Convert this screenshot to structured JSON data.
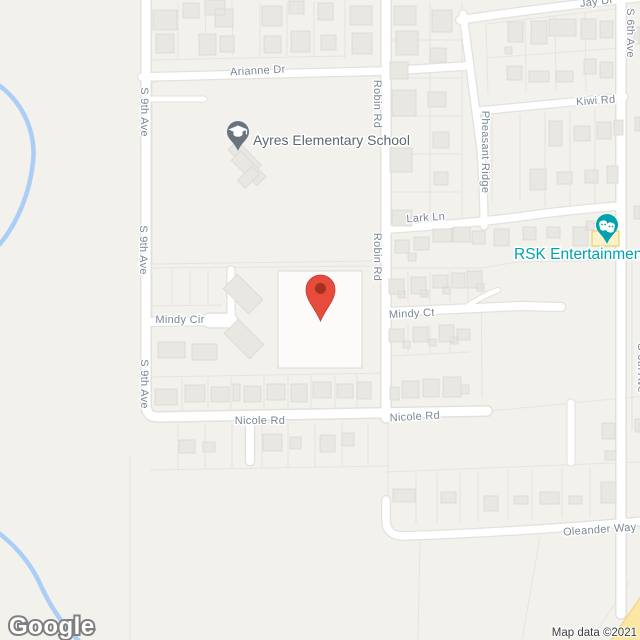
{
  "map": {
    "type": "google-maps-static-view",
    "streets": {
      "arianne_dr": "Arianne Dr",
      "s_9th_ave": "S 9th Ave",
      "robin_rd": "Robin Rd",
      "jay_dr": "Jay Dr",
      "s_6th_ave": "S 6th Ave",
      "kiwi_rd": "Kiwi Rd",
      "pheasant_ridge": "Pheasant Ridge",
      "lark_ln": "Lark Ln",
      "mindy_cir": "Mindy Cir",
      "mindy_ct": "Mindy Ct",
      "nicole_rd": "Nicole Rd",
      "oleander_way": "Oleander Way"
    },
    "pois": [
      {
        "name": "Ayres Elementary School",
        "type": "school",
        "icon": "graduation-cap-pin"
      },
      {
        "name": "RSK Entertainment",
        "type": "entertainment",
        "icon": "theater-masks-pin"
      }
    ],
    "marker": {
      "type": "red-location-pin"
    },
    "colors": {
      "land": "#f2f1ec",
      "road_fill": "#ffffff",
      "road_casing": "#e3e1dc",
      "major_road_yellow": "#fbe7a1",
      "building_fill": "#e9e7e2",
      "water_blue": "#abcdf6",
      "street_label": "#7b8795",
      "school_label": "#5b6770",
      "school_pin": "#6a7480",
      "entertainment_teal": "#00a2ac",
      "marker_red": "#e74b3c",
      "marker_red_dark": "#a5301f",
      "poi_highlight_fill": "#fbf2cd",
      "poi_highlight_stroke": "#edc84c"
    },
    "attribution": {
      "logo": "Google",
      "copyright": "Map data ©2021"
    }
  }
}
